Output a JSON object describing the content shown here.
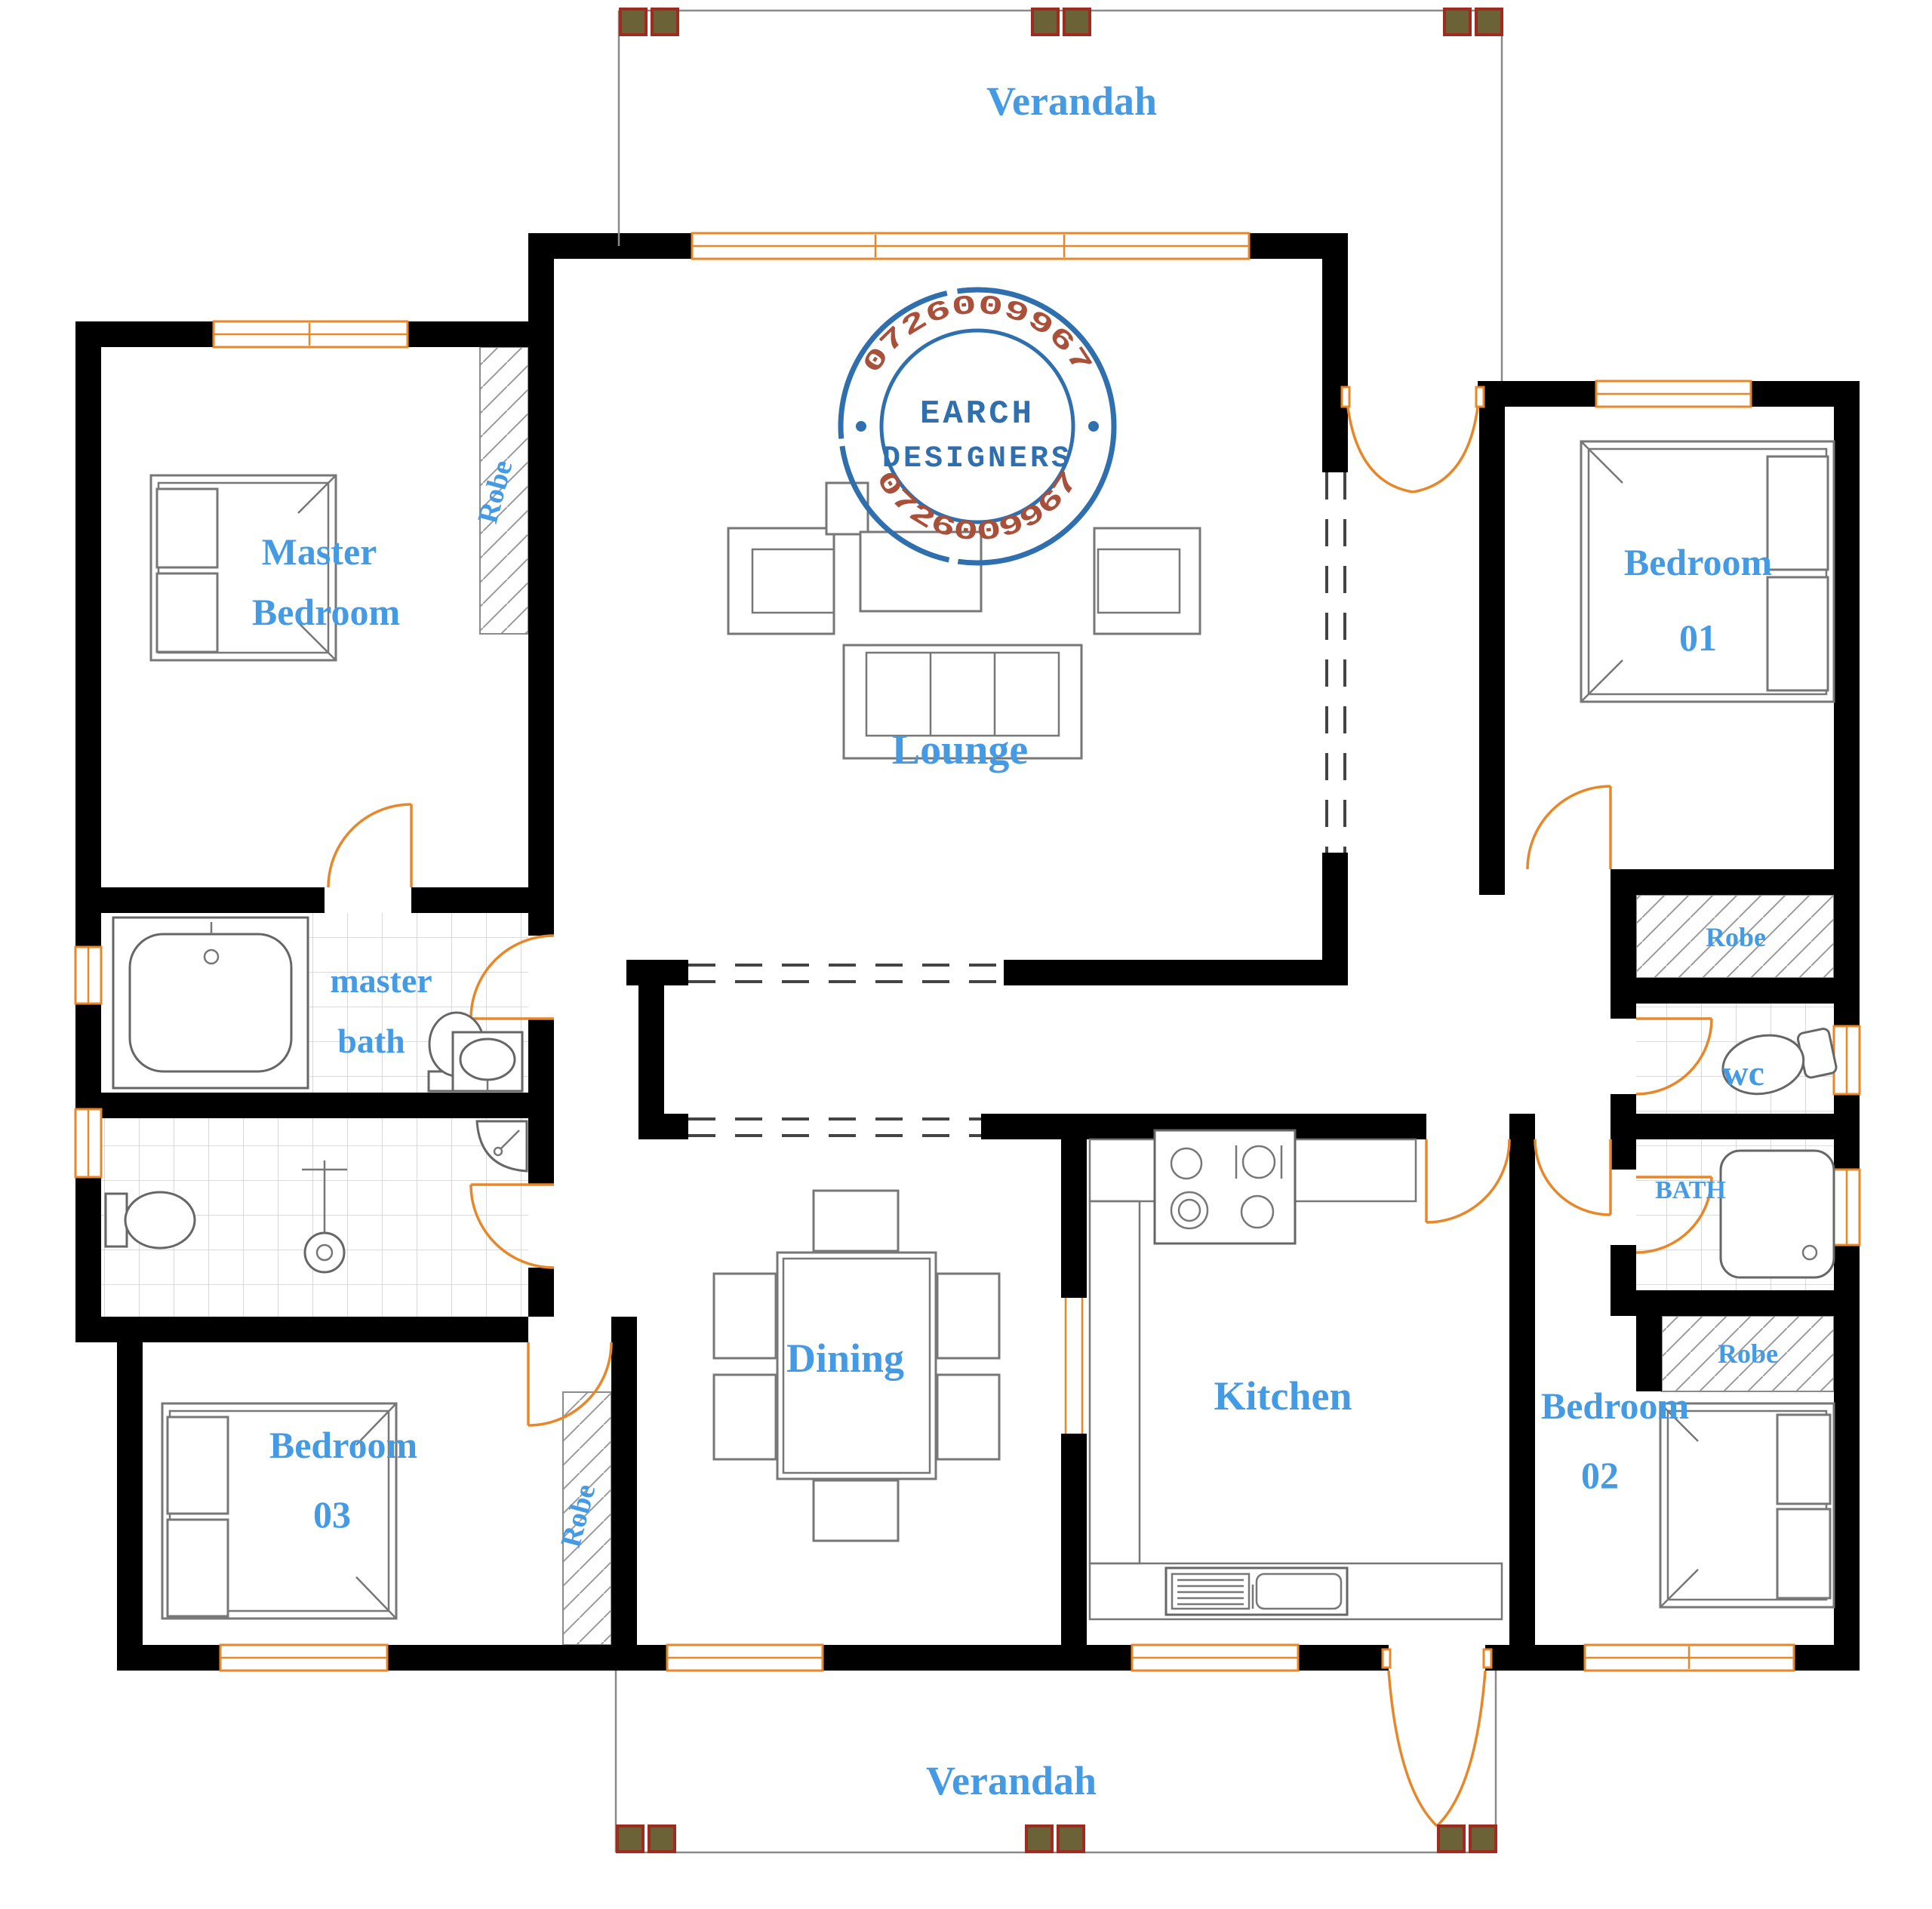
{
  "plan": {
    "type": "residential-floor-plan",
    "colors": {
      "wall": "#000000",
      "label_blue": "#459ae4",
      "window_orange": "#e8872a",
      "door_orange": "#e8872a",
      "stamp_blue": "#2f6fae",
      "stamp_number_red": "#a8503a",
      "column_fill": "#6b6238",
      "column_border": "#9e2b20",
      "furniture_gray": "#777777",
      "verandah_line_gray": "#8a8a8a"
    }
  },
  "rooms": {
    "verandah_top": {
      "label": "Verandah"
    },
    "verandah_bottom": {
      "label": "Verandah"
    },
    "master_bedroom": {
      "label_line1": "Master",
      "label_line2": "Bedroom"
    },
    "lounge": {
      "label": "Lounge"
    },
    "bedroom_01": {
      "label_line1": "Bedroom",
      "label_line2": "01"
    },
    "bedroom_02": {
      "label_line1": "Bedroom",
      "label_line2": "02"
    },
    "bedroom_03": {
      "label_line1": "Bedroom",
      "label_line2": "03"
    },
    "master_bath": {
      "label_line1": "master",
      "label_line2": "bath"
    },
    "dining": {
      "label": "Dining"
    },
    "kitchen": {
      "label": "Kitchen"
    },
    "wc": {
      "label": "wc"
    },
    "bath": {
      "label": "BATH"
    }
  },
  "robes": {
    "label": "Robe"
  },
  "stamp": {
    "name_line1": "EARCH",
    "name_line2": "DESIGNERS",
    "phone_top": "0726009967",
    "phone_bottom": "0726009967"
  }
}
